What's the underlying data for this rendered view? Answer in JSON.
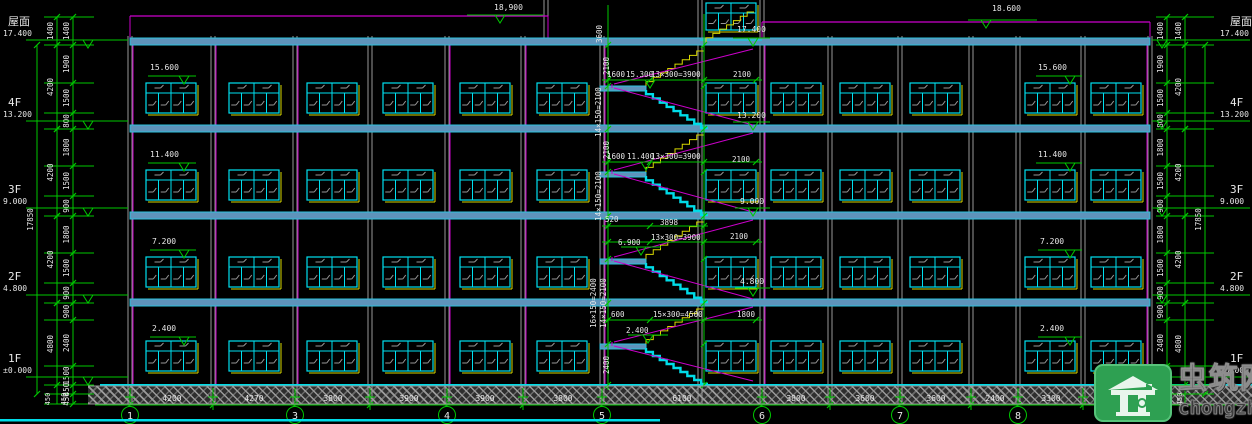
{
  "watermark": {
    "site_name": "虫筑网",
    "site_url": "chongzhu.cn",
    "logo": "house-icon"
  },
  "colors": {
    "bg": "#000000",
    "green": "#00c800",
    "cyan": "#00dce8",
    "window_cyan": "#00e0f0",
    "slab_fill": "#5e93bb",
    "slab_edge": "#2cc0dc",
    "magenta": "#cc00cc",
    "yellow": "#d8d800",
    "gray": "#989898",
    "text": "#e8e8e8",
    "watermark_green": "#2ea052",
    "watermark_text": "#3c3c3c"
  },
  "drawing": {
    "building": {
      "x1": 130,
      "x2": 1150,
      "ground_y": 385,
      "slab_y": [
        38,
        125,
        212,
        299
      ]
    },
    "parapet": [
      [
        130,
        548,
        16
      ],
      [
        762,
        1150,
        22
      ]
    ],
    "columns": [
      130,
      213,
      295,
      370,
      447,
      523,
      602,
      700,
      762,
      830,
      900,
      971,
      1018,
      1083,
      1150
    ],
    "magenta_walls": [
      133,
      216,
      298,
      450,
      526,
      605,
      765,
      1147
    ],
    "axes_ticks": [
      130,
      213,
      295,
      370,
      447,
      523,
      602,
      762,
      830,
      900,
      971,
      1018,
      1083,
      1150
    ],
    "axis_bubbles": [
      [
        "1",
        130
      ],
      [
        "3",
        295
      ],
      [
        "4",
        447
      ],
      [
        "5",
        602
      ],
      [
        "6",
        762
      ],
      [
        "7",
        900
      ],
      [
        "8",
        1018
      ]
    ],
    "bottom_dims": [
      [
        "4200",
        172
      ],
      [
        "4270",
        254
      ],
      [
        "3800",
        333
      ],
      [
        "3900",
        409
      ],
      [
        "3900",
        485
      ],
      [
        "3800",
        563
      ],
      [
        "6100",
        682
      ],
      [
        "3800",
        796
      ],
      [
        "3600",
        865
      ],
      [
        "3600",
        936
      ],
      [
        "2400",
        995
      ],
      [
        "3300",
        1051
      ]
    ],
    "window_rows": [
      [
        83,
        30
      ],
      [
        170,
        30
      ],
      [
        257,
        30
      ],
      [
        341,
        30
      ]
    ],
    "window_cols": [
      146,
      229,
      307,
      383,
      460,
      537,
      706,
      771,
      840,
      910,
      1025,
      1091
    ],
    "window_w": 50,
    "penthouse": {
      "x1": 700,
      "x2": 762,
      "win": [
        706,
        3,
        50,
        27
      ]
    },
    "stair_zones": [
      [
        45,
        129,
        86
      ],
      [
        129,
        216,
        172
      ],
      [
        216,
        303,
        259
      ],
      [
        303,
        385,
        344
      ]
    ],
    "stair_dim_rows": [
      [
        80,
        602,
        762
      ],
      [
        162,
        602,
        762
      ],
      [
        226,
        602,
        708
      ],
      [
        242,
        602,
        762
      ],
      [
        320,
        602,
        762
      ]
    ],
    "stair_dim_cols": [
      [
        608,
        5,
        390
      ],
      [
        704,
        14,
        385
      ]
    ],
    "left_chain": {
      "inner_x": 73,
      "outer_x": 57,
      "overall_x": 37,
      "tick_x1": 44,
      "tick_x2": 94,
      "inner": [
        [
          "1400",
          17,
          45
        ],
        [
          "1900",
          45,
          83
        ],
        [
          "1500",
          83,
          113
        ],
        [
          "800",
          113,
          129
        ],
        [
          "1800",
          129,
          166
        ],
        [
          "1500",
          166,
          196
        ],
        [
          "900",
          196,
          216
        ],
        [
          "1800",
          216,
          253
        ],
        [
          "1500",
          253,
          283
        ],
        [
          "900",
          283,
          303
        ],
        [
          "900",
          303,
          320
        ],
        [
          "2400",
          320,
          366
        ],
        [
          "1500",
          366,
          385
        ],
        [
          "450",
          385,
          394
        ],
        [
          "450",
          394,
          404
        ]
      ],
      "outer": [
        [
          "1400",
          17,
          45
        ],
        [
          "4200",
          45,
          129
        ],
        [
          "4200",
          129,
          216
        ],
        [
          "4200",
          216,
          303
        ],
        [
          "4800",
          303,
          385
        ]
      ],
      "overall": [
        [
          "17850",
          45,
          394
        ]
      ]
    },
    "right_chain": {
      "inner_x": 1167,
      "outer_x": 1185,
      "overall_x": 1205,
      "tick_x1": 1156,
      "tick_x2": 1214,
      "inner": [
        [
          "1400",
          17,
          45
        ],
        [
          "1900",
          45,
          83
        ],
        [
          "1500",
          83,
          113
        ],
        [
          "800",
          113,
          129
        ],
        [
          "1800",
          129,
          166
        ],
        [
          "1500",
          166,
          196
        ],
        [
          "900",
          196,
          216
        ],
        [
          "1800",
          216,
          253
        ],
        [
          "1500",
          253,
          283
        ],
        [
          "900",
          283,
          303
        ],
        [
          "900",
          303,
          320
        ],
        [
          "2400",
          320,
          366
        ],
        [
          "1500",
          366,
          385
        ],
        [
          "450",
          385,
          394
        ],
        [
          "450",
          394,
          404
        ]
      ],
      "outer": [
        [
          "1400",
          17,
          45
        ],
        [
          "4200",
          45,
          129
        ],
        [
          "4200",
          129,
          216
        ],
        [
          "4200",
          216,
          303
        ],
        [
          "4800",
          303,
          385
        ]
      ],
      "overall": [
        [
          "17850",
          45,
          394
        ]
      ]
    },
    "floor_markers_left": [
      [
        "屋面",
        "17.400",
        40
      ],
      [
        "4F",
        "13.200",
        121
      ],
      [
        "3F",
        "9.000",
        208
      ],
      [
        "2F",
        "4.800",
        295
      ],
      [
        "1F",
        "±0.000",
        377
      ]
    ],
    "floor_markers_right": [
      [
        "屋面",
        "17.400",
        40
      ],
      [
        "4F",
        "13.200",
        121
      ],
      [
        "3F",
        "9.000",
        208
      ],
      [
        "2F",
        "4.800",
        295
      ],
      [
        "1F",
        "±0.000",
        377
      ]
    ],
    "elev_markers": [
      [
        "18,900",
        494,
        10,
        467,
        543,
        15,
        500
      ],
      [
        "18.600",
        992,
        11,
        968,
        1037,
        20,
        986
      ],
      [
        "17.400",
        737,
        32,
        733,
        770,
        38,
        753
      ],
      [
        "13.200",
        737,
        118,
        733,
        770,
        122,
        753
      ],
      [
        "9.000",
        740,
        204,
        735,
        770,
        208,
        753
      ],
      [
        "4.800",
        740,
        284,
        735,
        770,
        288,
        753
      ],
      [
        "15.600",
        150,
        70,
        148,
        196,
        76,
        184
      ],
      [
        "11.400",
        150,
        157,
        148,
        196,
        163,
        184
      ],
      [
        "7.200",
        152,
        244,
        150,
        196,
        250,
        184
      ],
      [
        "2.400",
        152,
        331,
        150,
        196,
        337,
        184
      ],
      [
        "15.600",
        1038,
        70,
        1036,
        1082,
        76,
        1070
      ],
      [
        "11.400",
        1038,
        157,
        1036,
        1082,
        163,
        1070
      ],
      [
        "7.200",
        1040,
        244,
        1038,
        1082,
        250,
        1070
      ],
      [
        "2.400",
        1040,
        331,
        1038,
        1082,
        337,
        1070
      ],
      [
        "",
        0,
        0,
        628,
        668,
        80,
        650
      ],
      [
        "",
        0,
        0,
        624,
        664,
        162,
        646
      ],
      [
        "",
        0,
        0,
        621,
        661,
        247,
        641
      ],
      [
        "",
        0,
        0,
        628,
        668,
        335,
        648
      ]
    ],
    "texts": [
      [
        "1600",
        607,
        77
      ],
      [
        "15.300",
        626,
        77
      ],
      [
        "13×300=3900",
        651,
        77
      ],
      [
        "2100",
        733,
        77
      ],
      [
        "1600",
        607,
        159
      ],
      [
        "11.400",
        627,
        159
      ],
      [
        "13×300=3900",
        651,
        159
      ],
      [
        "2100",
        732,
        162
      ],
      [
        "520",
        605,
        222
      ],
      [
        "3898",
        660,
        225
      ],
      [
        "6.900",
        618,
        245
      ],
      [
        "13×300=3900",
        651,
        240
      ],
      [
        "2100",
        730,
        239
      ],
      [
        "600",
        611,
        317
      ],
      [
        "15×300=4500",
        653,
        317
      ],
      [
        "1800",
        737,
        317
      ],
      [
        "2.400",
        626,
        333
      ],
      [
        "3600",
        602,
        34,
        "v"
      ],
      [
        "2100",
        609,
        66,
        "v"
      ],
      [
        "14×150=2100",
        601,
        112,
        "v"
      ],
      [
        "2100",
        609,
        150,
        "v"
      ],
      [
        "14×150=2100",
        601,
        196,
        "v"
      ],
      [
        "16×150=2400",
        596,
        303,
        "v"
      ],
      [
        "14×150=2100",
        606,
        303,
        "v"
      ],
      [
        "2400",
        609,
        365,
        "v"
      ]
    ],
    "foundation_labels": [
      [
        "450",
        50,
        399
      ],
      [
        "450",
        66,
        399
      ],
      [
        "450",
        1164,
        399
      ],
      [
        "450",
        1182,
        399
      ]
    ],
    "bottom_cyan_strip": [
      0,
      660
    ]
  }
}
